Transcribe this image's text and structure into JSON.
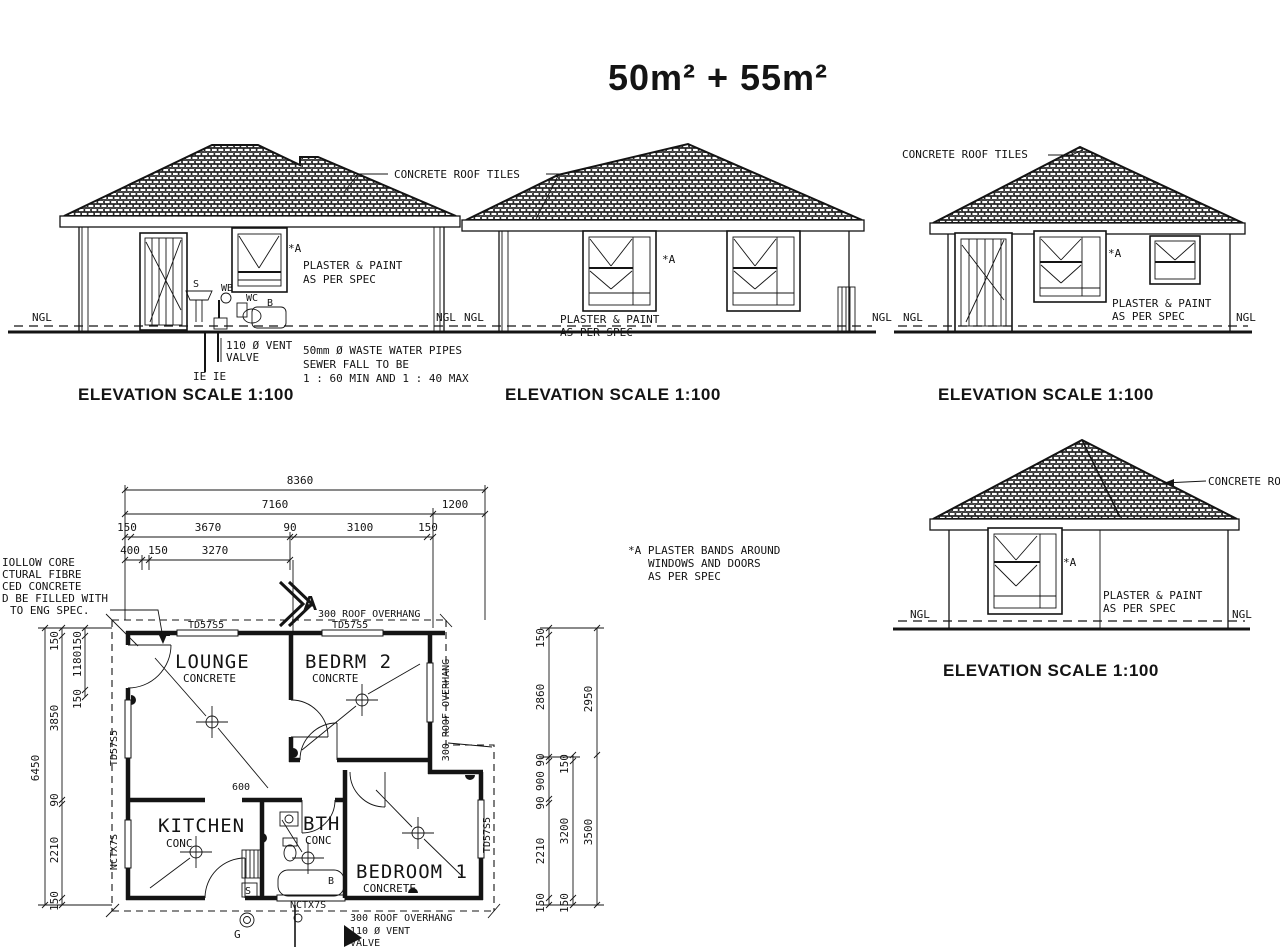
{
  "title": "50m² + 55m²",
  "shared": {
    "concrete_roof_tiles": "CONCRETE ROOF TILES",
    "elevation_title": "ELEVATION  SCALE 1:100",
    "ngl": "NGL",
    "star_a": "*A",
    "plaster1": "PLASTER & PAINT",
    "plaster2": "AS PER SPEC"
  },
  "elev1": {
    "vent1": "110 Ø VENT",
    "vent2": "VALVE",
    "ie": "IE IE",
    "waste1": "50mm Ø WASTE WATER PIPES",
    "waste2": "SEWER FALL TO BE",
    "waste3": "1 :  60 MIN AND 1 :  40 MAX",
    "s": "S",
    "wb": "WB",
    "wc": "WC",
    "b": "B"
  },
  "note_a": {
    "l1": "*A PLASTER BANDS AROUND",
    "l2": "WINDOWS AND DOORS",
    "l3": "AS PER SPEC"
  },
  "side_note": {
    "l1": "IOLLOW CORE",
    "l2": "CTURAL FIBRE",
    "l3": "CED CONCRETE",
    "l4": "D BE FILLED WITH",
    "l5": "TO ENG SPEC."
  },
  "plan": {
    "rooms": {
      "lounge": {
        "name": "LOUNGE",
        "floor": "CONCRETE"
      },
      "bedrm2": {
        "name": "BEDRM 2",
        "floor": "CONCRTE"
      },
      "kitchen": {
        "name": "KITCHEN",
        "floor": "CONC"
      },
      "bth": {
        "name": "BTH",
        "floor": "CONC"
      },
      "bedroom1": {
        "name": "BEDROOM 1",
        "floor": "CONCRETE"
      }
    },
    "overhang": "300 ROOF OVERHANG",
    "section_letter": "A",
    "td57s5": "TD57S5",
    "nctx7s": "NCTX7S",
    "vent1": "110 Ø VENT",
    "vent2": "VALVE",
    "g": "G",
    "s": "S",
    "b": "B",
    "dim600": "600",
    "dims": {
      "overall_w": "8360",
      "w1": "7160",
      "w2": "1200",
      "top_chain": [
        "150",
        "3670",
        "90",
        "3100",
        "150"
      ],
      "row4": [
        "400",
        "150",
        "3270"
      ],
      "overall_h": "6450",
      "left_chain": [
        "150",
        "3850",
        "90",
        "2210",
        "150"
      ],
      "left_inner": [
        "150",
        "1180",
        "150"
      ],
      "right_chain": [
        "150",
        "2860",
        "90",
        "900",
        "90",
        "2210",
        "150"
      ],
      "right_mid": [
        "150",
        "3200",
        "150"
      ],
      "right_outer": [
        "2950",
        "3500"
      ]
    }
  }
}
